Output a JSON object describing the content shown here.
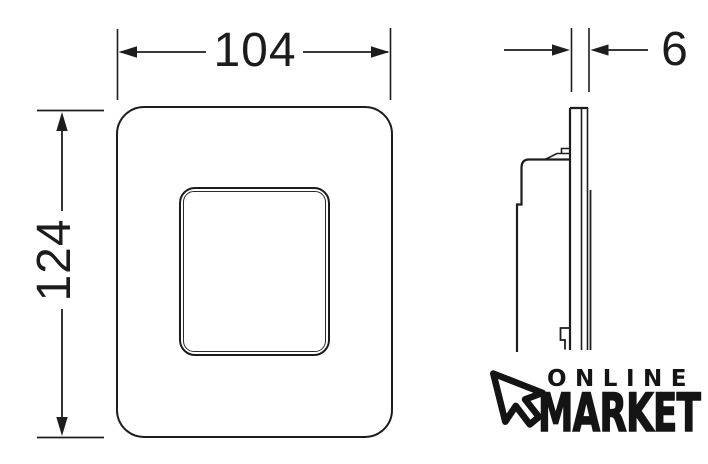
{
  "drawing": {
    "dimensions": {
      "width_label": "104",
      "height_label": "124",
      "depth_label": "6"
    }
  },
  "logo": {
    "line1": "ONLINE",
    "line2": "MARKET"
  },
  "colors": {
    "ink": "#1d1d1d",
    "background": "#ffffff"
  }
}
